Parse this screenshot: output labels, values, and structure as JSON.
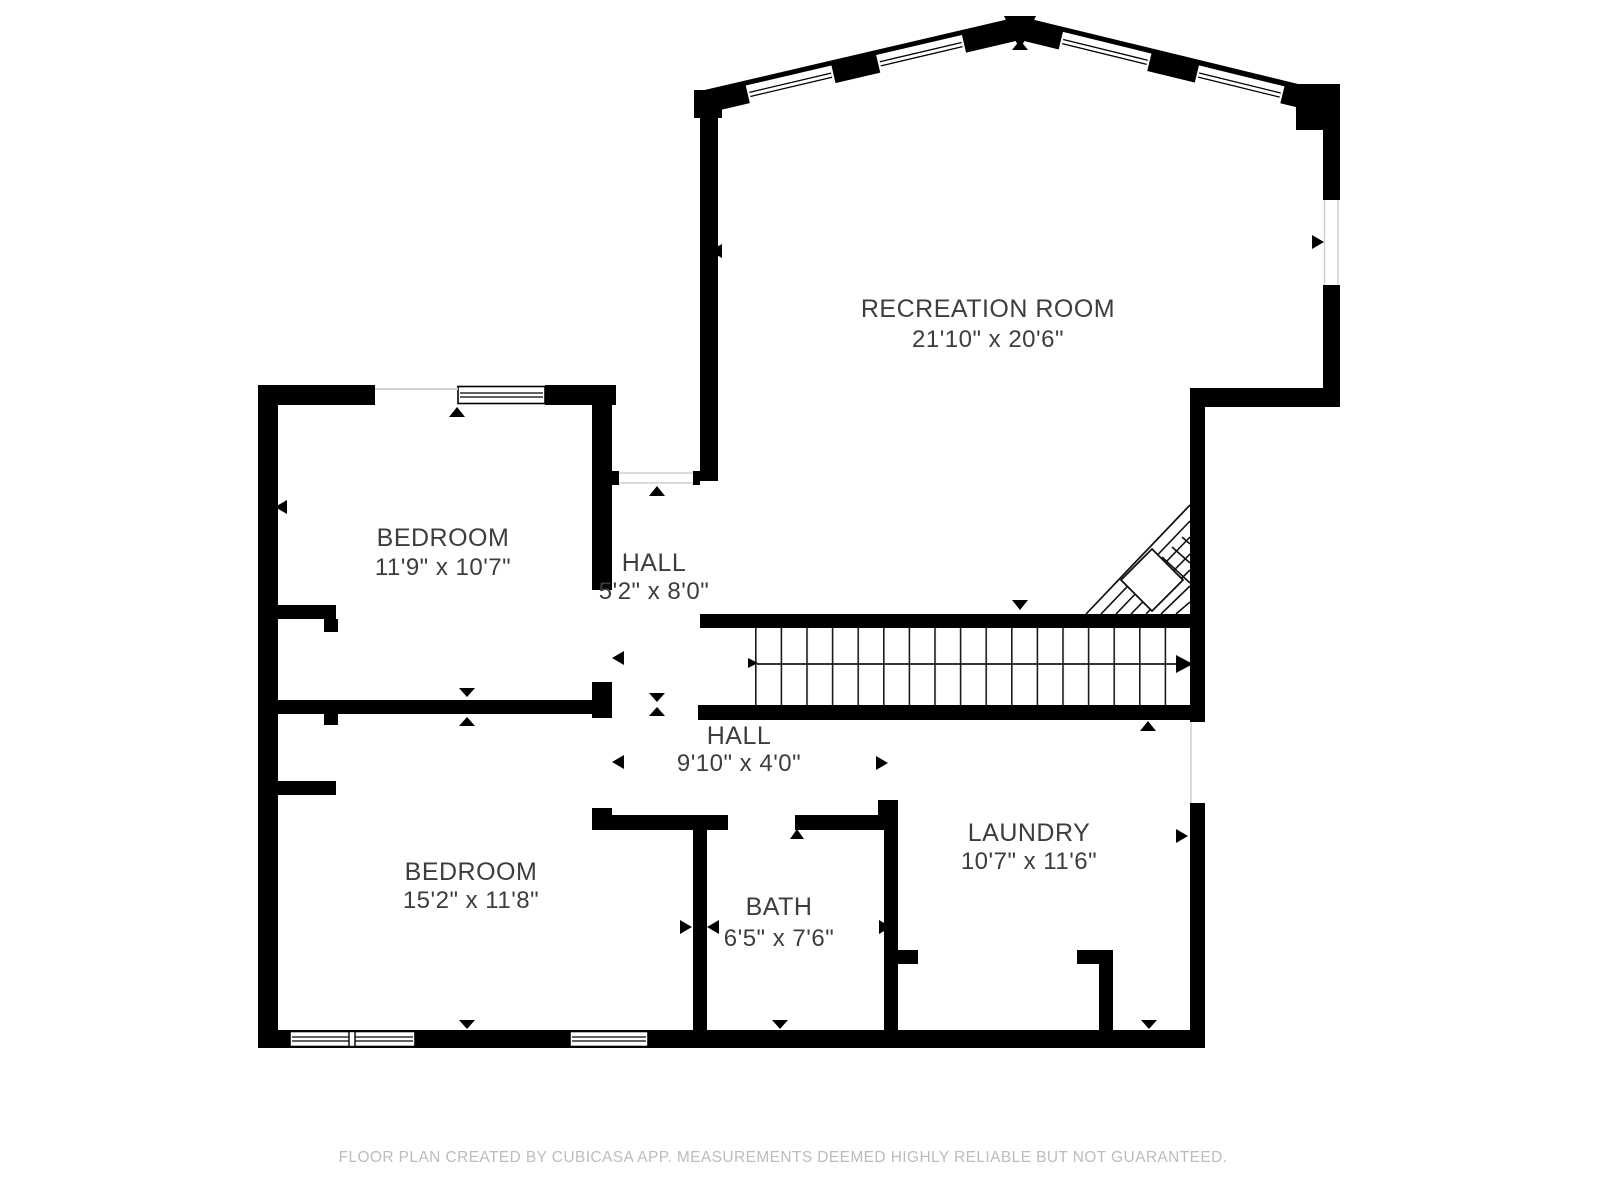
{
  "rooms": [
    {
      "name": "RECREATION ROOM",
      "dims": "21'10\" x 20'6\""
    },
    {
      "name": "BEDROOM",
      "dims": "11'9\" x 10'7\""
    },
    {
      "name": "HALL",
      "dims": "5'2\" x 8'0\""
    },
    {
      "name": "HALL",
      "dims": "9'10\" x 4'0\""
    },
    {
      "name": "BEDROOM",
      "dims": "15'2\" x 11'8\""
    },
    {
      "name": "BATH",
      "dims": "6'5\" x 7'6\""
    },
    {
      "name": "LAUNDRY",
      "dims": "10'7\" x 11'6\""
    }
  ],
  "footer": {
    "text": "FLOOR PLAN CREATED BY CUBICASA APP. MEASUREMENTS DEEMED HIGHLY RELIABLE BUT NOT GUARANTEED."
  },
  "colors": {
    "wall": "#000000",
    "label": "#3d3d3d",
    "footer": "#bcbcbc",
    "background": "#ffffff"
  }
}
